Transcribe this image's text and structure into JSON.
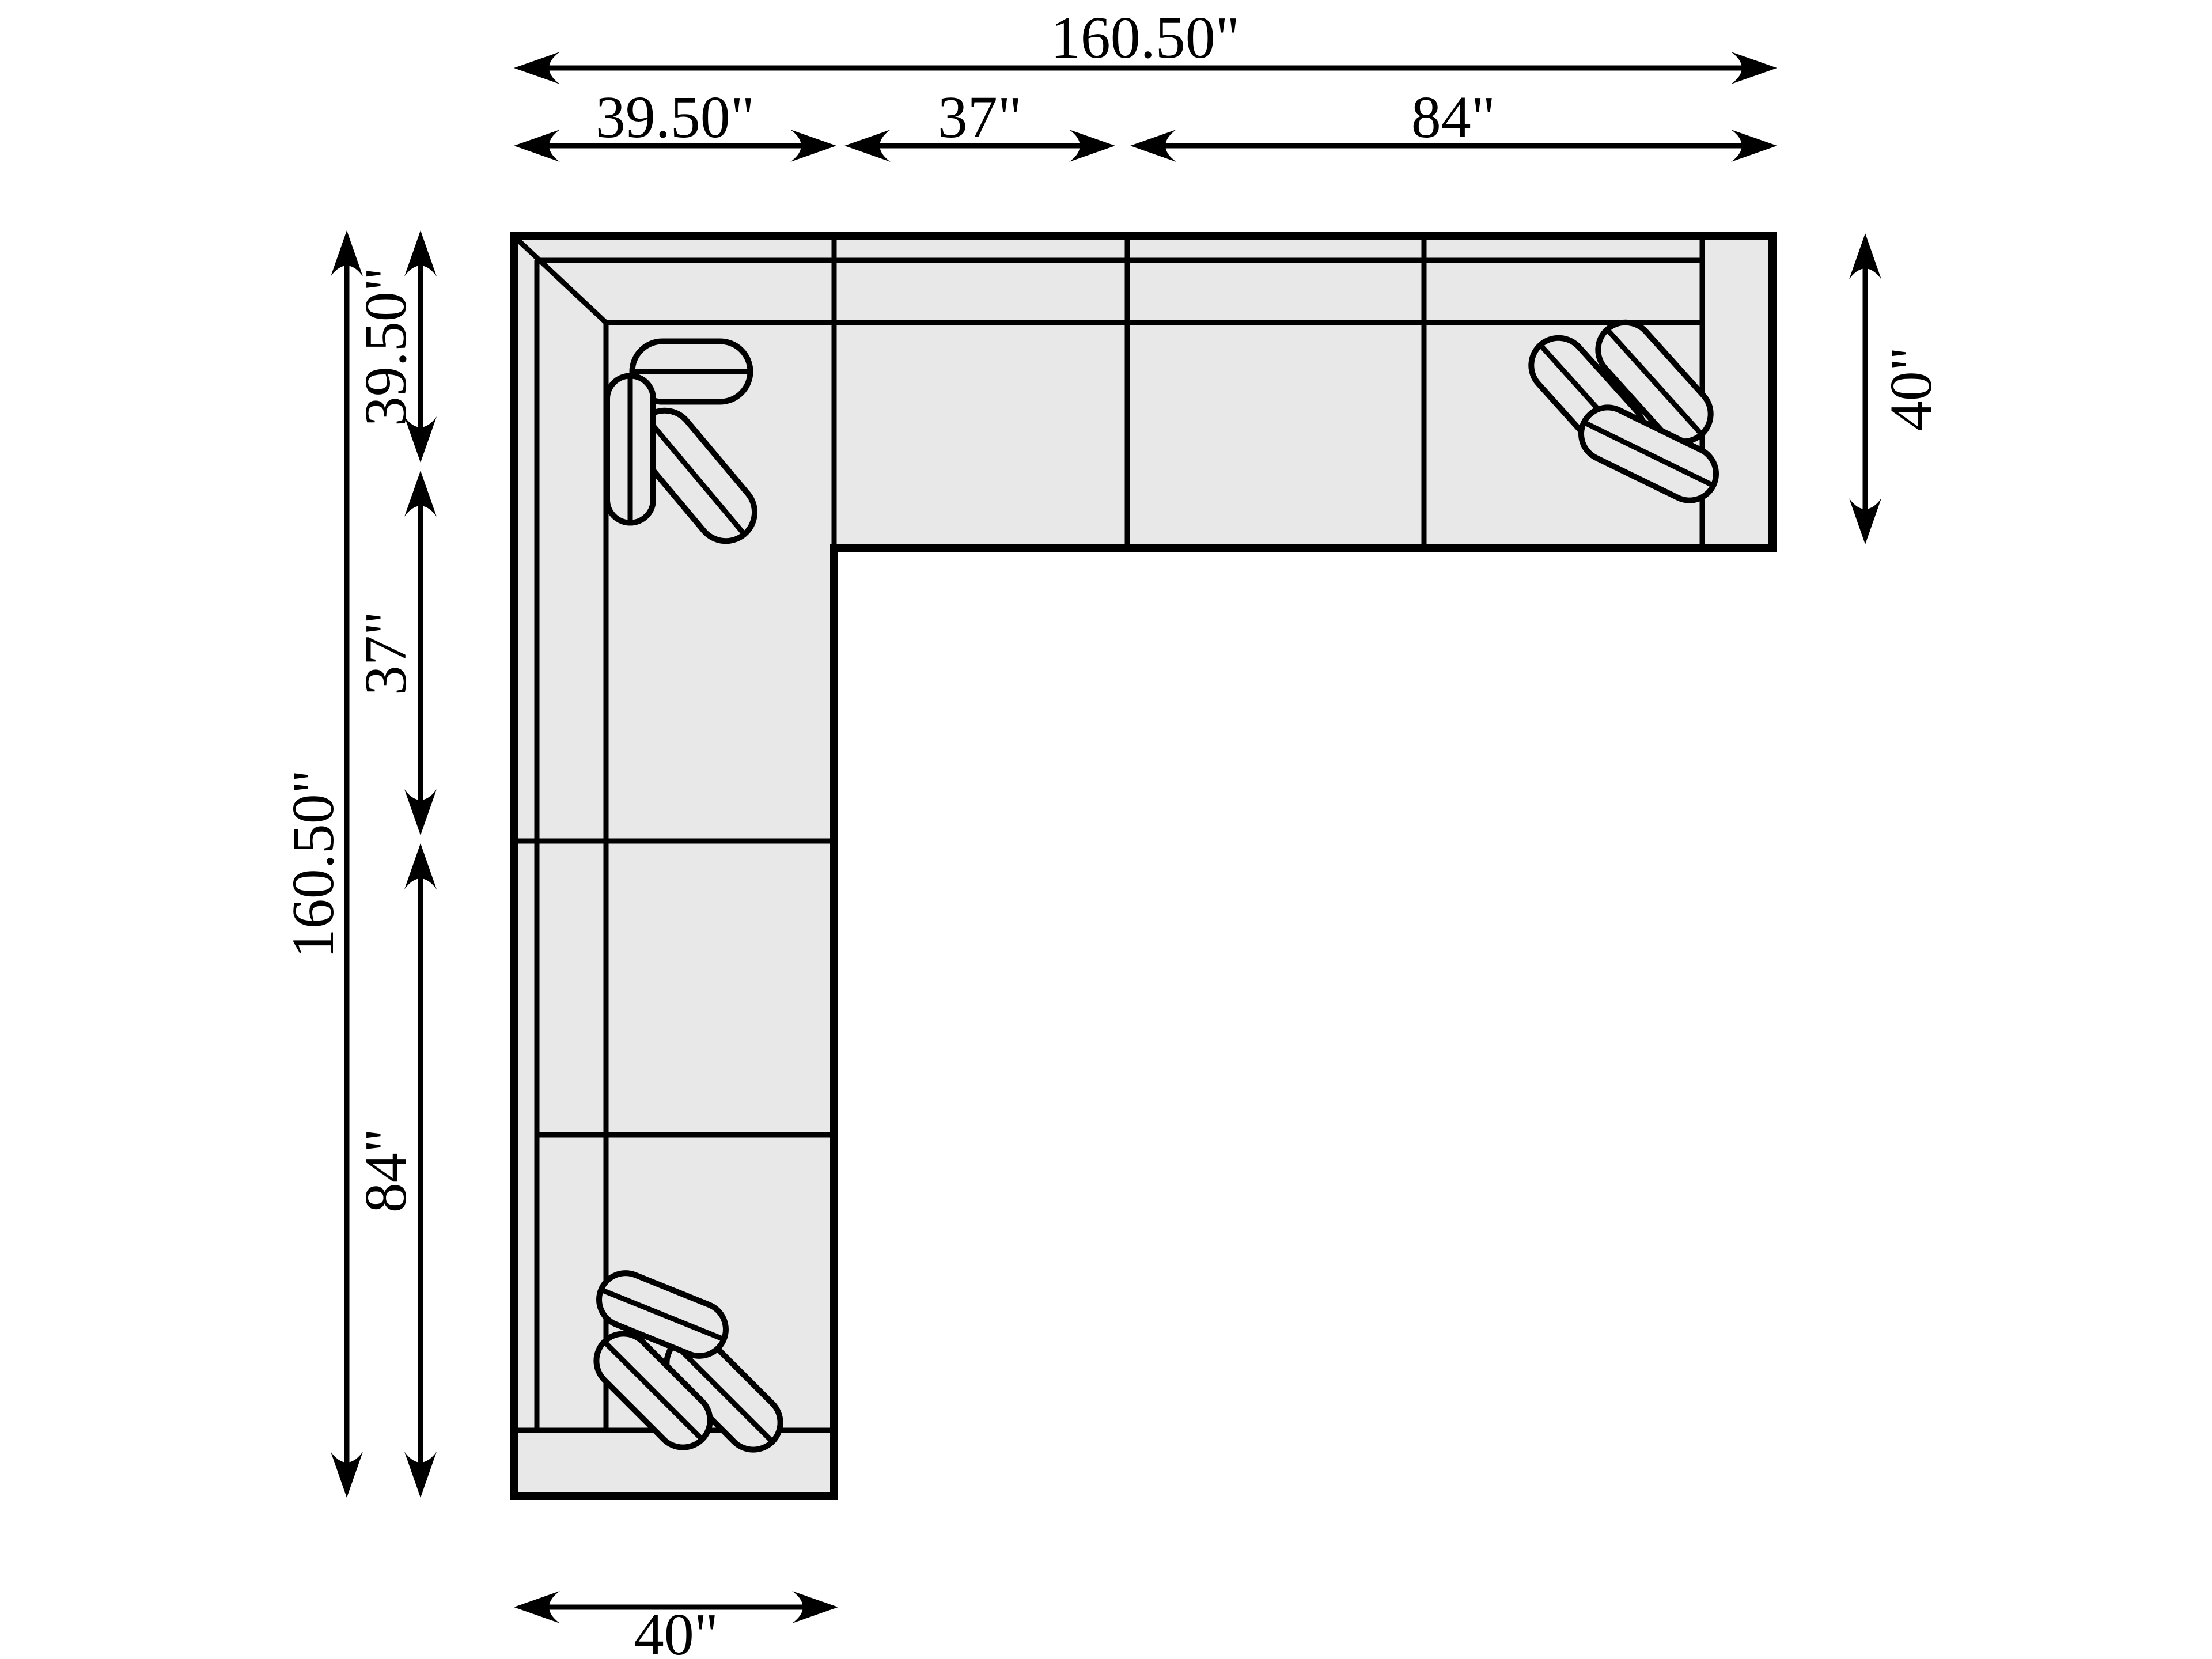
{
  "diagram": {
    "type": "sectional-sofa-floor-plan",
    "orientation": "L-shape, corner at top-left",
    "colors": {
      "line": "#000000",
      "sofa_fill": "#e8e8e8",
      "background": "#ffffff"
    },
    "pillow_groups": [
      {
        "location": "corner-seat",
        "count": 3
      },
      {
        "location": "right-end-seat",
        "count": 3
      },
      {
        "location": "bottom-end-seat",
        "count": 3
      }
    ]
  },
  "dims": {
    "top": {
      "overall": "160.50\"",
      "seg1": "39.50\"",
      "seg2": "37\"",
      "seg3": "84\""
    },
    "left": {
      "overall": "160.50\"",
      "seg1": "39.50\"",
      "seg2": "37\"",
      "seg3": "84\""
    },
    "right": {
      "depth": "40\""
    },
    "bottom": {
      "depth": "40\""
    }
  }
}
